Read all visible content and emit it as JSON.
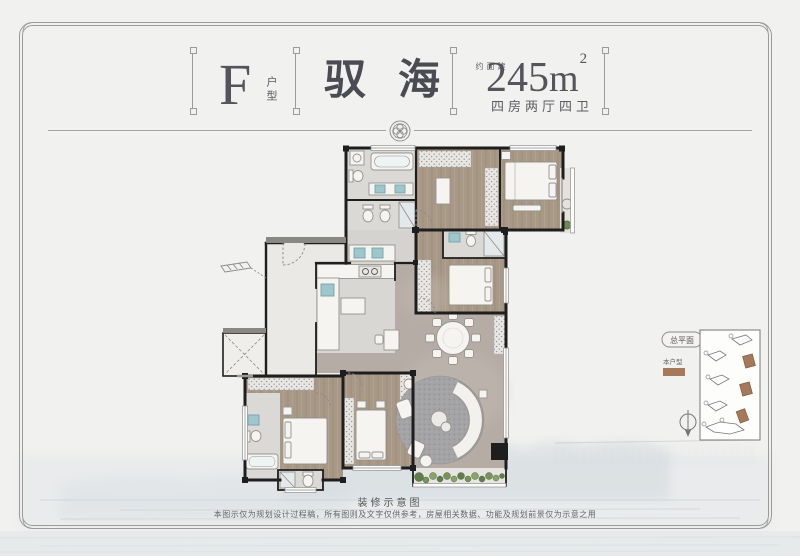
{
  "page": {
    "background": "#f1f1ef",
    "frame_color": "#9b9b9b"
  },
  "header": {
    "unit_letter": "F",
    "unit_type_label": "户型",
    "project_title": "驭海",
    "area_prefix": "建面约",
    "area_value": "245",
    "area_unit": "m",
    "area_exponent": "2",
    "layout_text": "四房两厅四卫"
  },
  "siteplan": {
    "title": "总平面",
    "legend_label": "本户型",
    "highlight_color": "#a5795a"
  },
  "captions": {
    "plan_caption": "装修示意图",
    "disclaimer": "本图示仅为规划设计过程稿，所有图则及文字仅供参考，房屋相关数据、功能及规划前景仅为示意之用"
  },
  "colors": {
    "wall": "#1e1e1e",
    "wood_floor": "#a79785",
    "tile_floor": "#dbd9d5",
    "stone_floor": "#b5aca5",
    "fixture_blue": "#9fc6cb",
    "plant_green": "#5f7d4b",
    "text_dark": "#54545c"
  },
  "icons": {
    "rosette": "rosette-emblem",
    "north_arrow": "north-arrow",
    "elevator": "elevator-cross"
  }
}
